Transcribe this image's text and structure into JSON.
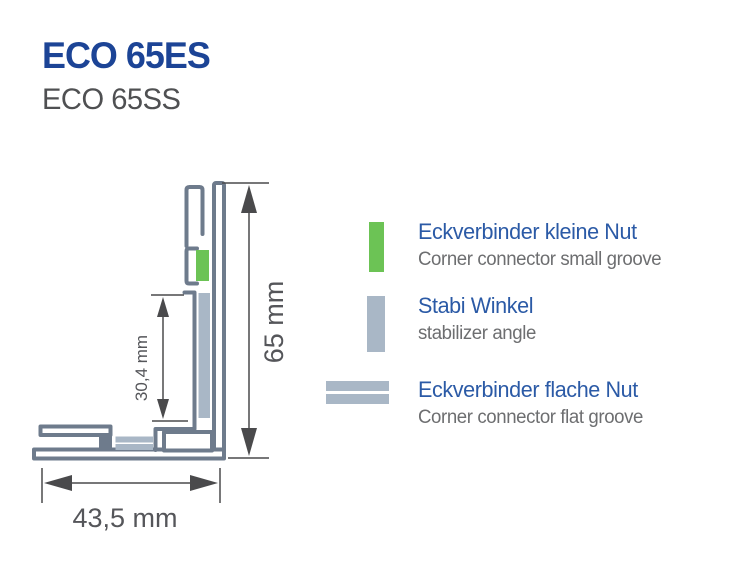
{
  "header": {
    "title": "ECO 65ES",
    "subtitle": "ECO 65SS"
  },
  "diagram": {
    "type": "profile-cross-section",
    "dimensions": {
      "total_height": "65 mm",
      "groove_depth": "30,4 mm",
      "total_width": "43,5 mm"
    }
  },
  "legend": {
    "items": [
      {
        "swatch": "small-groove-connector-swatch",
        "swatch_color": "#6cc355",
        "title": "Eckverbinder kleine Nut",
        "subtitle": "Corner connector small groove"
      },
      {
        "swatch": "stabilizer-angle-swatch",
        "swatch_color": "#a9b7c6",
        "title": "Stabi Winkel",
        "subtitle": "stabilizer angle"
      },
      {
        "swatch": "flat-groove-connector-swatch",
        "swatch_color": "#a9b7c6",
        "title": "Eckverbinder flache Nut",
        "subtitle": "Corner connector flat groove"
      }
    ]
  },
  "colors": {
    "title_blue": "#1c4496",
    "legend_heading_blue": "#2b5aa6",
    "text_gray": "#6d6e70",
    "dimension_gray": "#4a4a4c",
    "profile_outline": "#6e7b8c",
    "stabilizer_fill": "#a9b7c6",
    "connector_green": "#6cc355"
  }
}
